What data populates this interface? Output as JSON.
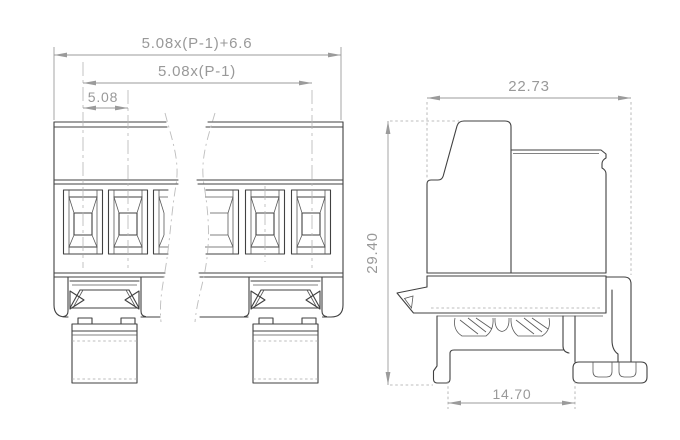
{
  "meta": {
    "drawing_type": "terminal block technical drawing",
    "views": [
      "front-view",
      "side-view"
    ]
  },
  "colors": {
    "background": "#ffffff",
    "object_line": "#414141",
    "dimension_line": "#9b9b9b",
    "dimension_text": "#999999",
    "centerline": "#b5b5b5",
    "break_line": "#bdbdbd"
  },
  "front_view": {
    "dim_overall_length": "5.08x(P-1)+6.6",
    "dim_pole_span": "5.08x(P-1)",
    "dim_pitch": "5.08"
  },
  "side_view": {
    "dim_depth": "22.73",
    "dim_height": "29.40",
    "dim_rail_slot_width": "14.70"
  }
}
